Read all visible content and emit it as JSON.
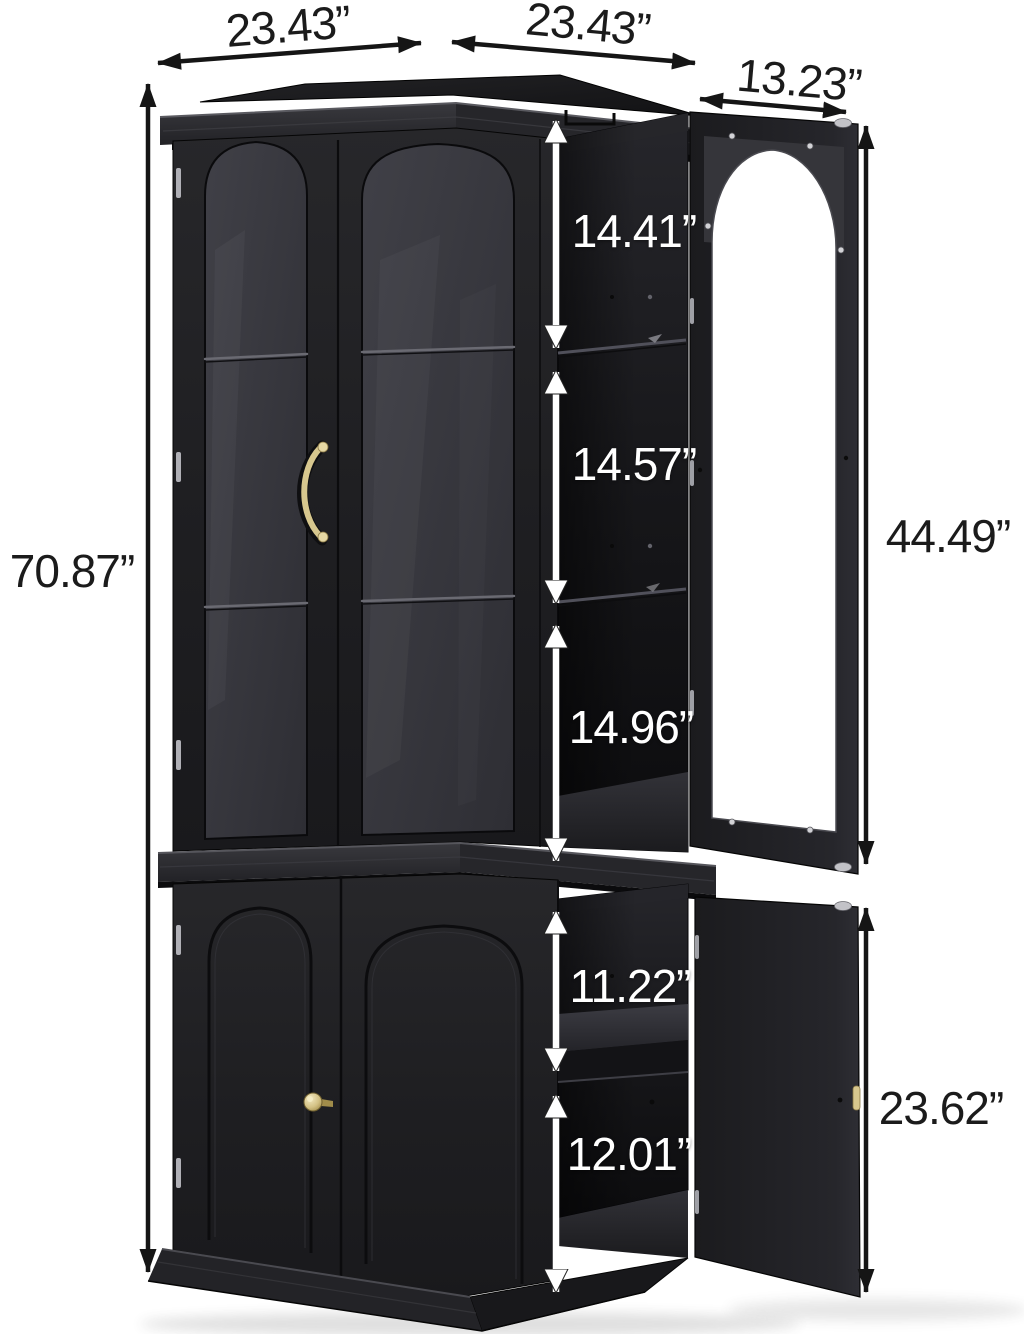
{
  "background": "#ffffff",
  "palette": {
    "cabinet_black": "#1e1e21",
    "interior_black": "#121215",
    "hardware_gold": "#d7c78e",
    "hardware_silver": "#c2c2c7",
    "dimension_text_dark": "#1b1b1b",
    "dimension_text_light": "#ffffff",
    "window_white": "#ffffff"
  },
  "measurements": {
    "top_left_width": "23.43”",
    "top_right_width": "23.43”",
    "open_door_width": "13.23”",
    "total_height": "70.87”",
    "upper_compartment_1": "14.41”",
    "upper_compartment_2": "14.57”",
    "upper_compartment_3": "14.96”",
    "upper_door_height": "44.49”",
    "lower_compartment_1": "11.22”",
    "lower_compartment_2": "12.01”",
    "lower_door_height": "23.62”"
  }
}
